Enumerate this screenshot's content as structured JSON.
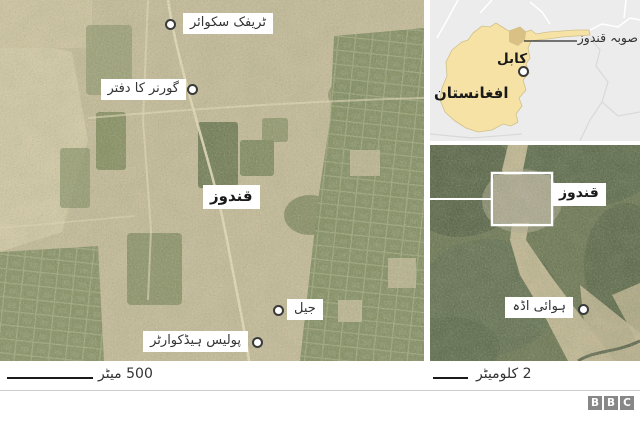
{
  "left_map": {
    "city_label": "قندوز",
    "points": [
      {
        "id": "traffic-square",
        "label": "ٹریفک سکوائر"
      },
      {
        "id": "governor-office",
        "label": "گورنر کا دفتر"
      },
      {
        "id": "jail",
        "label": "جیل"
      },
      {
        "id": "police-hq",
        "label": "پولیس ہیڈکوارٹر"
      }
    ],
    "scale_label": "500 میٹر"
  },
  "inset_map": {
    "province_label": "صوبہ قندوز",
    "capital_label": "کابل",
    "country_label": "افغانستان"
  },
  "right_map": {
    "city_label": "قندوز",
    "points": [
      {
        "id": "airport",
        "label": "ہوائی اڈہ"
      }
    ],
    "scale_label": "2 کلومیٹر"
  },
  "branding": {
    "letters": [
      "B",
      "B",
      "C"
    ]
  },
  "colors": {
    "afghanistan_fill": "#f7e2a5",
    "kunduz_province_fill": "#d9c185",
    "inset_background": "#ececec",
    "label_text": "#333333",
    "bbc_gray": "#878787"
  }
}
